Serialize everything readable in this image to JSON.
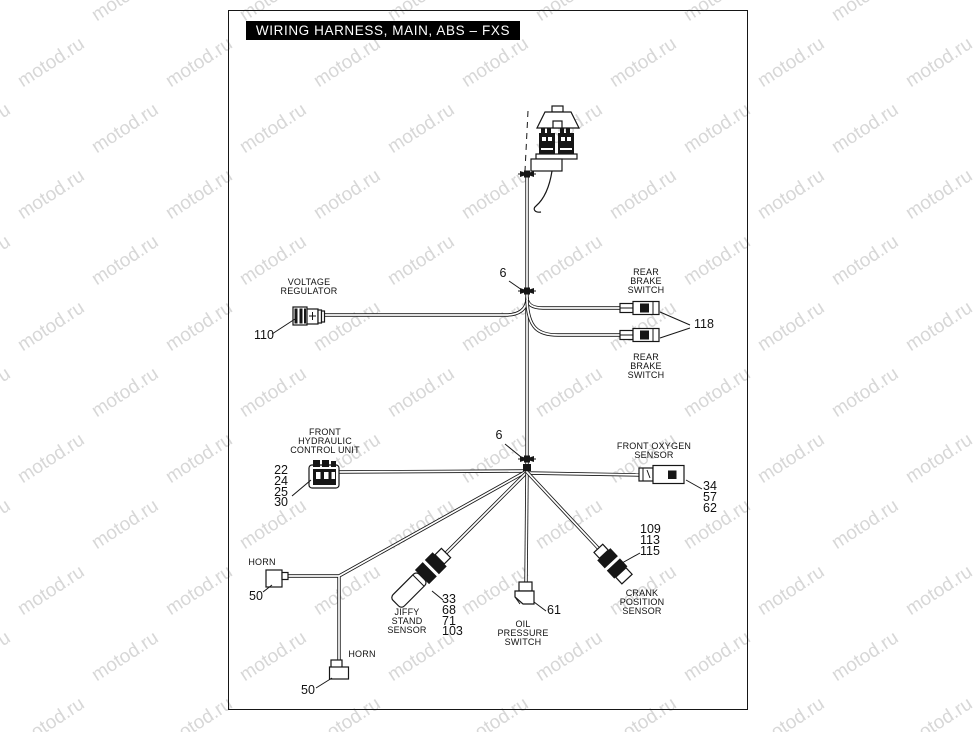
{
  "title": "WIRING HARNESS, MAIN, ABS – FXS",
  "watermark": {
    "text": "motod.ru"
  },
  "labels": {
    "voltage_regulator": "VOLTAGE\nREGULATOR",
    "rear_brake_switch_top": "REAR\nBRAKE\nSWITCH",
    "rear_brake_switch_bottom": "REAR\nBRAKE\nSWITCH",
    "front_hydraulic_control_unit": "FRONT\nHYDRAULIC\nCONTROL UNIT",
    "front_oxygen_sensor": "FRONT OXYGEN\nSENSOR",
    "horn_upper": "HORN",
    "horn_lower": "HORN",
    "jiffy_stand_sensor": "JIFFY\nSTAND\nSENSOR",
    "oil_pressure_switch": "OIL\nPRESSURE\nSWITCH",
    "crank_position_sensor": "CRANK\nPOSITION\nSENSOR"
  },
  "callouts": {
    "voltage_regulator": "110",
    "rear_brake_switches": "118",
    "clamp_top": "6",
    "clamp_mid": "6",
    "front_hydraulic_control_unit": "22\n24\n25\n30",
    "front_oxygen_sensor": "34\n57\n62",
    "horn_upper": "50",
    "horn_lower": "50",
    "jiffy_stand_sensor": "33\n68\n71\n103",
    "oil_pressure_switch": "61",
    "crank_position_sensor": "109\n113\n115"
  },
  "colors": {
    "line": "#161616",
    "title_bg": "#000000",
    "title_fg": "#ffffff",
    "watermark": "#d7d7d7"
  }
}
